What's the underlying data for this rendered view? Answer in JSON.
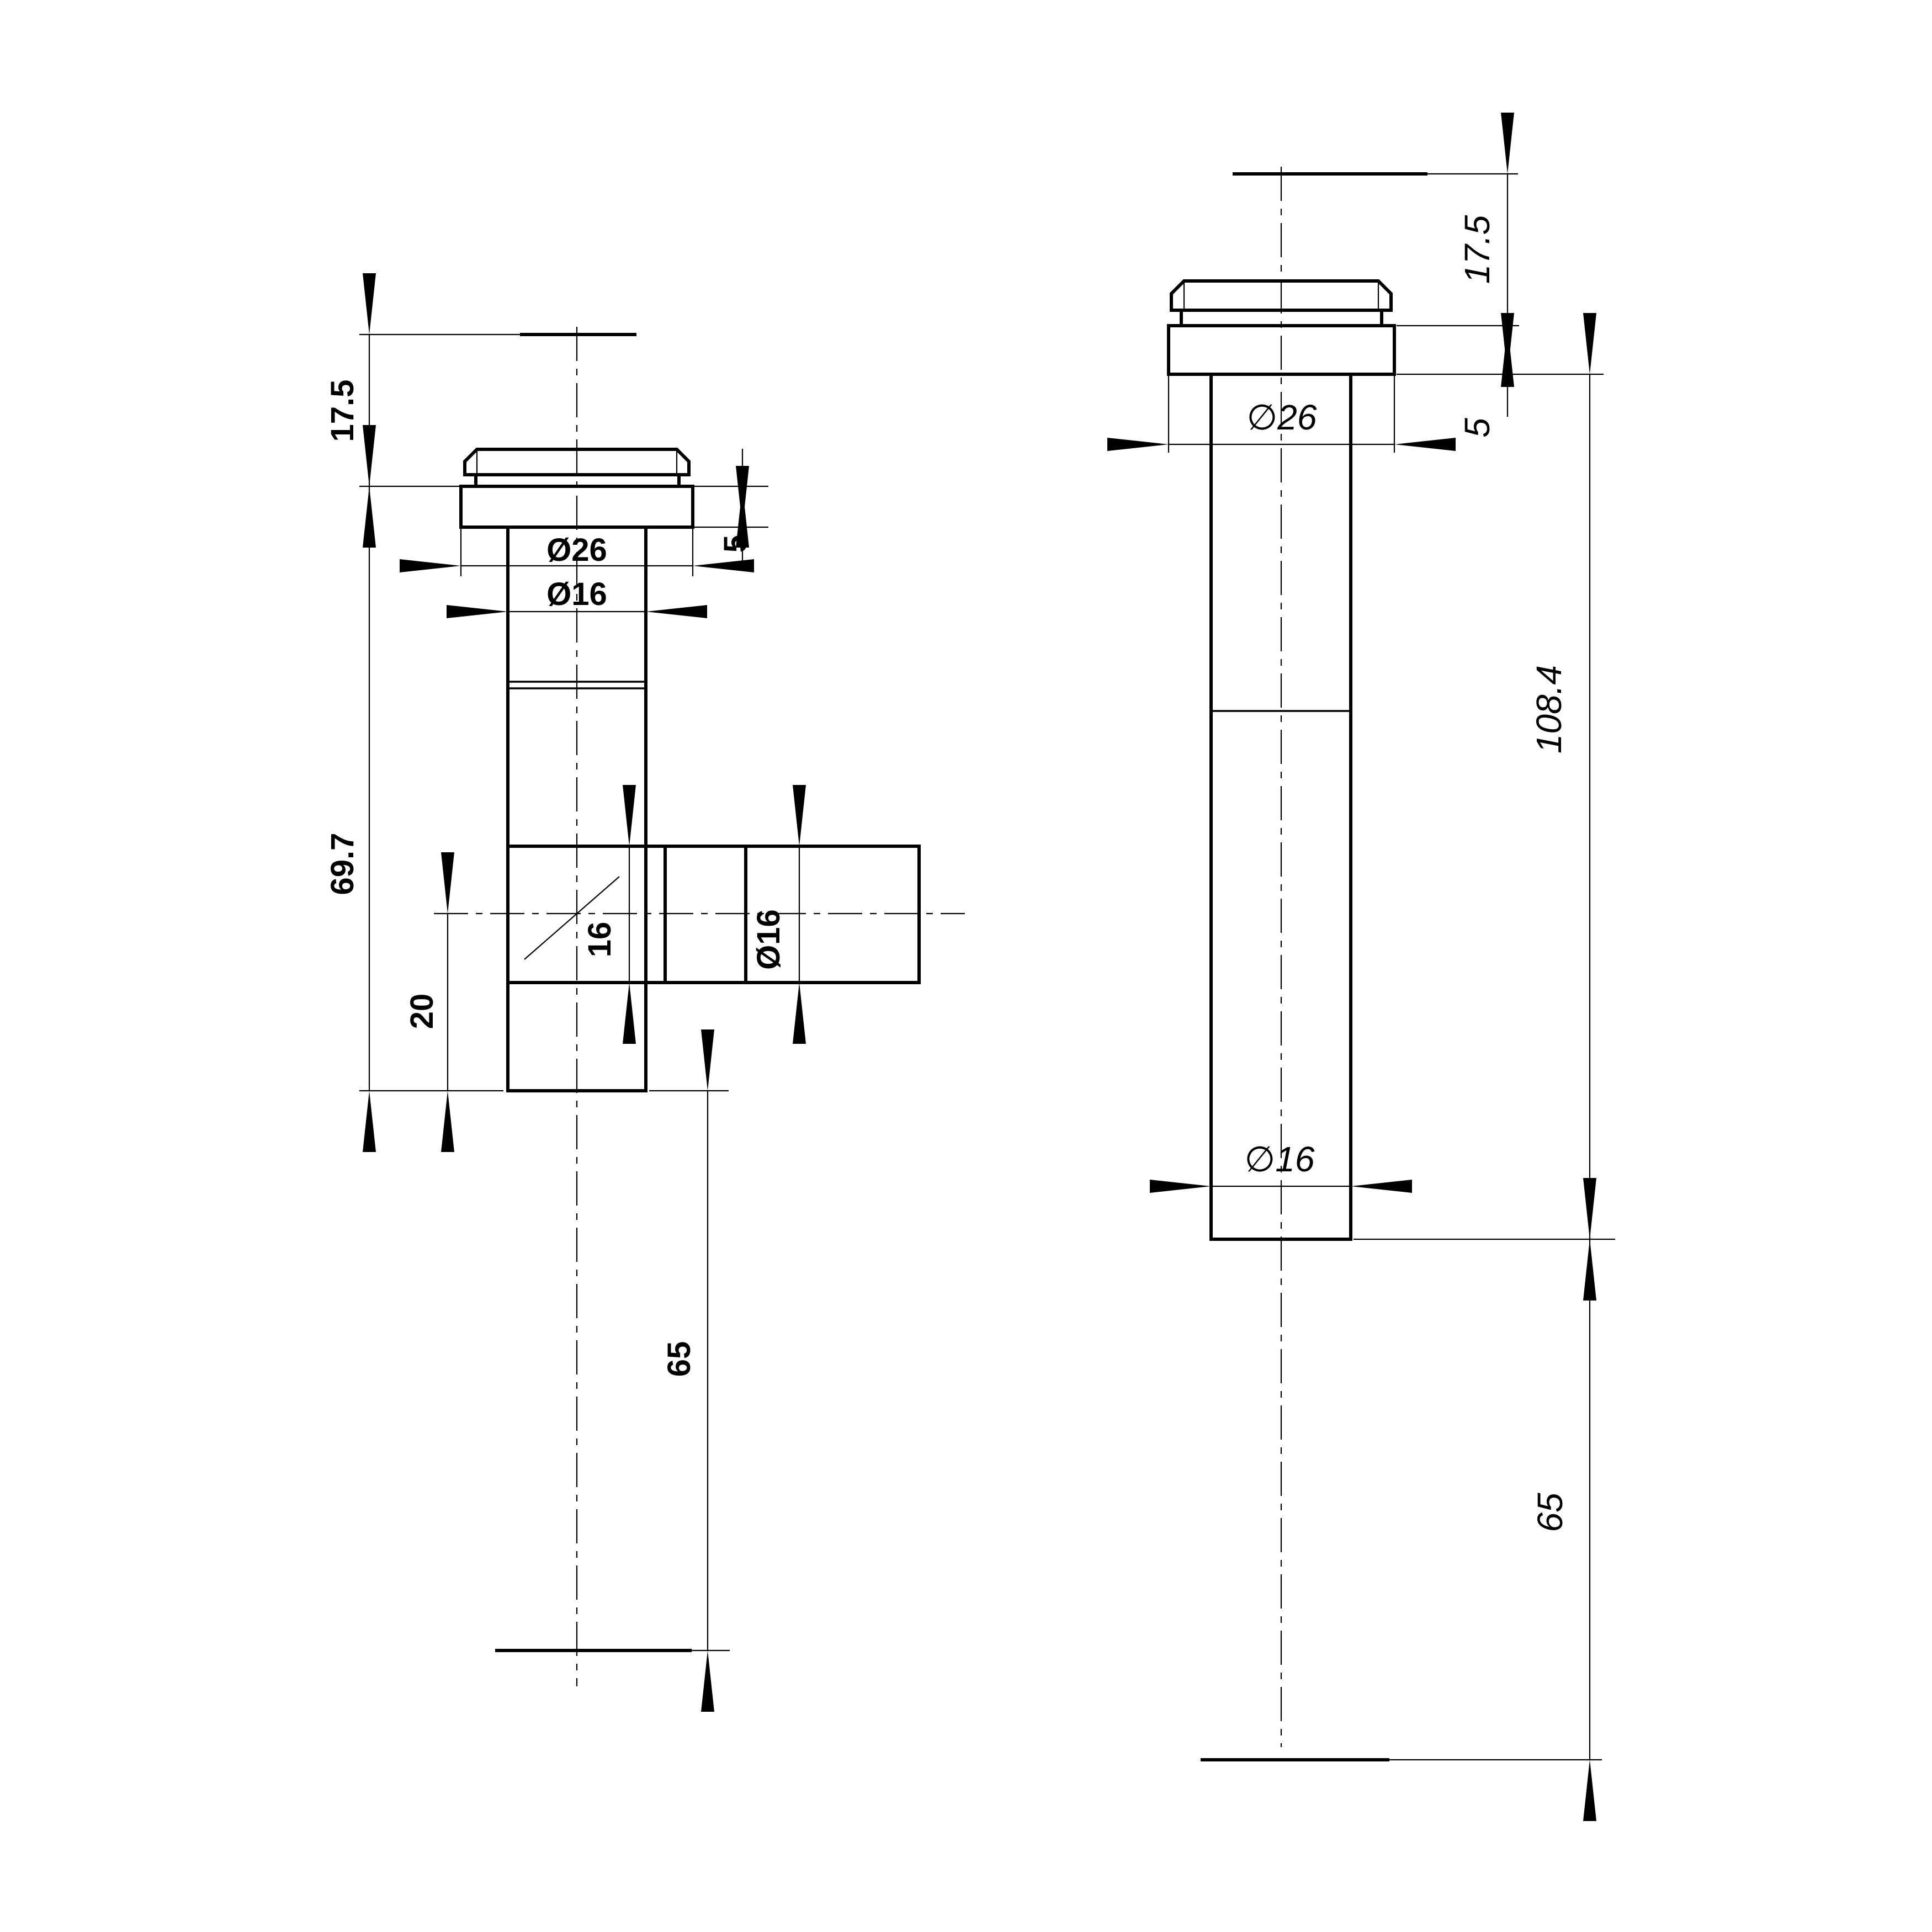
{
  "drawing": {
    "background_color": "#ffffff",
    "line_color": "#000000",
    "left_view": {
      "name": "side elevation with branch outlet",
      "dims": {
        "top_offset": "17.5",
        "flange_height": "5",
        "flange_dia": "Ø26",
        "tube_dia": "Ø16",
        "overall_length": "69.7",
        "branch_width": "16",
        "branch_dia": "Ø16",
        "outlet_to_end": "20",
        "tail_length": "65"
      }
    },
    "right_view": {
      "name": "side elevation rotated",
      "dims": {
        "top_offset": "17.5",
        "flange_height": "5",
        "flange_dia": "∅26",
        "body_length": "108.4",
        "tube_dia": "∅16",
        "tail_length": "65"
      }
    }
  }
}
